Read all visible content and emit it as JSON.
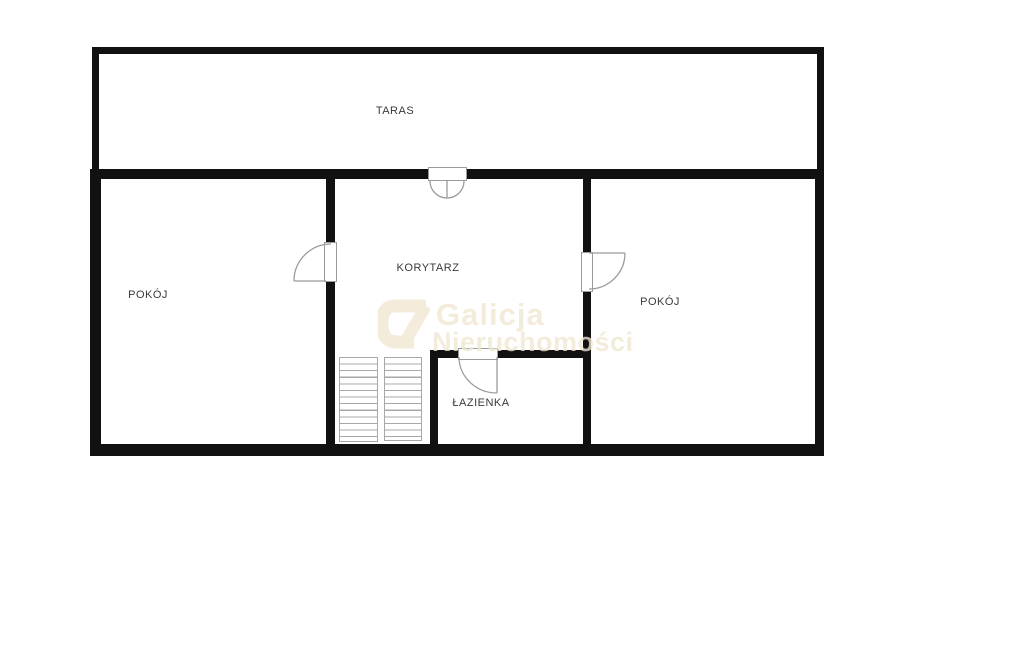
{
  "plan": {
    "title": "floor-plan",
    "rooms": [
      {
        "id": "taras",
        "label": "TARAS"
      },
      {
        "id": "pokoj-left",
        "label": "POKÓJ"
      },
      {
        "id": "korytarz",
        "label": "KORYTARZ"
      },
      {
        "id": "pokoj-right",
        "label": "POKÓJ"
      },
      {
        "id": "lazienka",
        "label": "ŁAZIENKA"
      }
    ],
    "features": {
      "doors": [
        "taras-double-door",
        "pokoj-left-door",
        "pokoj-right-door",
        "lazienka-door"
      ],
      "stairs_flights": 2
    },
    "colors": {
      "wall": "#111111",
      "label_text": "#3a3a3a",
      "door_symbol": "#9b9b9b",
      "stairs": "#a8a8a8",
      "watermark": "#f0e7d2",
      "background": "#ffffff"
    }
  },
  "watermark": {
    "logo": "galicja-g-logo",
    "line1": "Galicja",
    "line2": "Nieruchomości"
  }
}
